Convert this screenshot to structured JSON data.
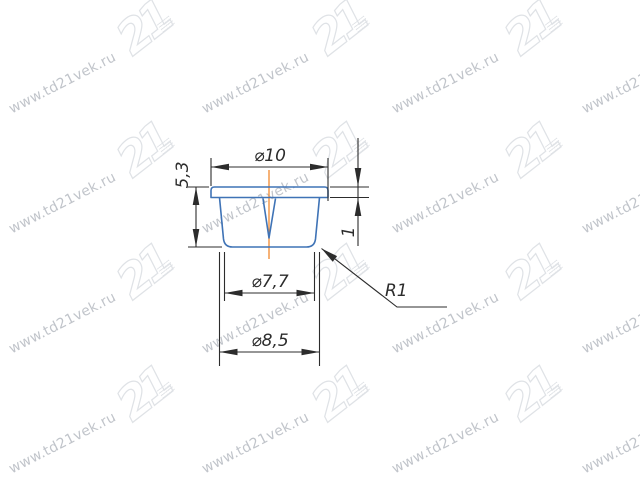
{
  "canvas": {
    "width": 640,
    "height": 480,
    "background": "#ffffff"
  },
  "watermark": {
    "text": "www.td21vek.ru",
    "logo_text": "21",
    "text_color": "#b6bac1",
    "logo_outline_color": "#dfe2e6",
    "text_columns_x": [
      10,
      203,
      393,
      583
    ],
    "text_rows_y": [
      62,
      182,
      302,
      422
    ],
    "logo_columns_x": [
      116,
      311,
      504
    ],
    "logo_rows_y": [
      0,
      122,
      244,
      366
    ]
  },
  "drawing": {
    "type": "technical-cross-section",
    "part": "round furniture plug / cap, sectional view",
    "colors": {
      "part_outline": "#3f73b6",
      "centerline": "#f2913d",
      "dimension_lines": "#2c2c2c"
    },
    "dimensions": {
      "top_diameter": "⌀10",
      "overall_height": "5,3",
      "flange_thickness": "1",
      "bottom_diameter": "⌀7,7",
      "body_diameter": "⌀8,5",
      "corner_radius": "R1"
    }
  }
}
